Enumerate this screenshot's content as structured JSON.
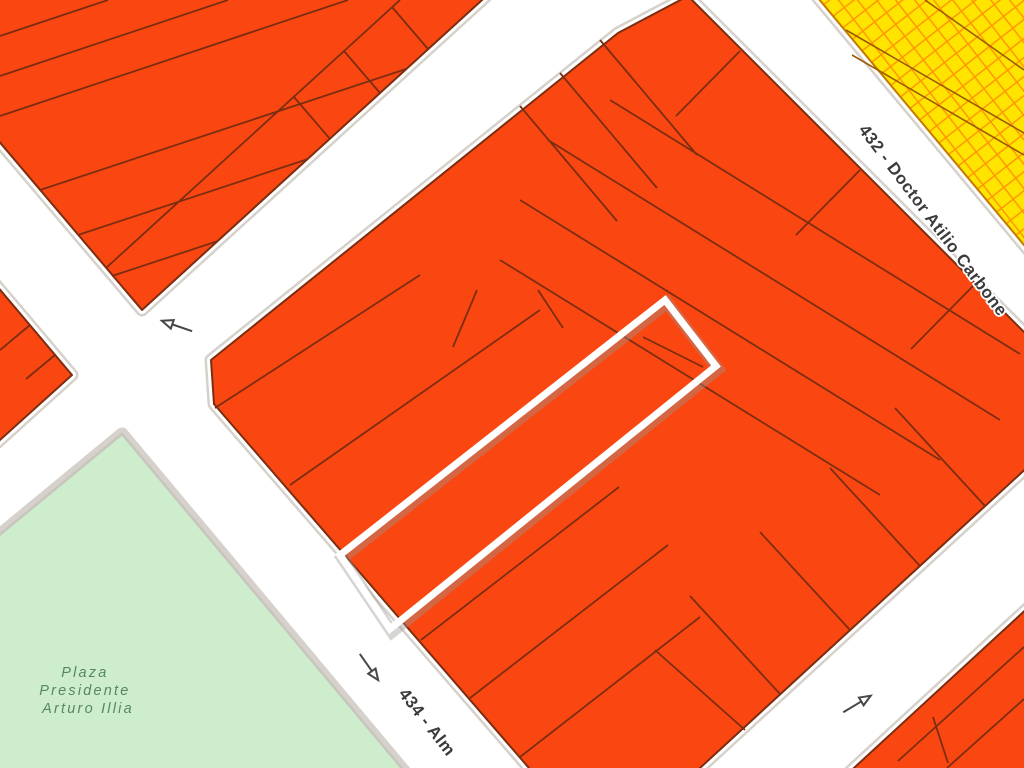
{
  "map": {
    "streets": [
      {
        "id": "432",
        "label": "432 - Doctor Atilio Carbone"
      },
      {
        "id": "434",
        "label": "434 - Alm"
      }
    ],
    "park": {
      "name_line1": "Plaza",
      "name_line2": "Presidente",
      "name_line3": "Arturo Illia"
    },
    "one_way_arrows": [
      {
        "direction": "southwest"
      },
      {
        "direction": "southeast"
      },
      {
        "direction": "northeast"
      }
    ],
    "highlight": {
      "type": "selected-parcel-outline"
    }
  },
  "colors": {
    "parcel_fill": "#FA4711",
    "parcel_border": "#7C2D10",
    "commercial_fill": "#FFE400",
    "commercial_hatch": "#FF9800",
    "park_fill": "#CDEDCC",
    "park_text": "#55895D",
    "street_fill": "#FFFFFF",
    "curb": "#D6D2CB",
    "street_text": "#3B3B3B",
    "highlight_stroke": "#FFFFFF",
    "arrow": "#474747"
  }
}
